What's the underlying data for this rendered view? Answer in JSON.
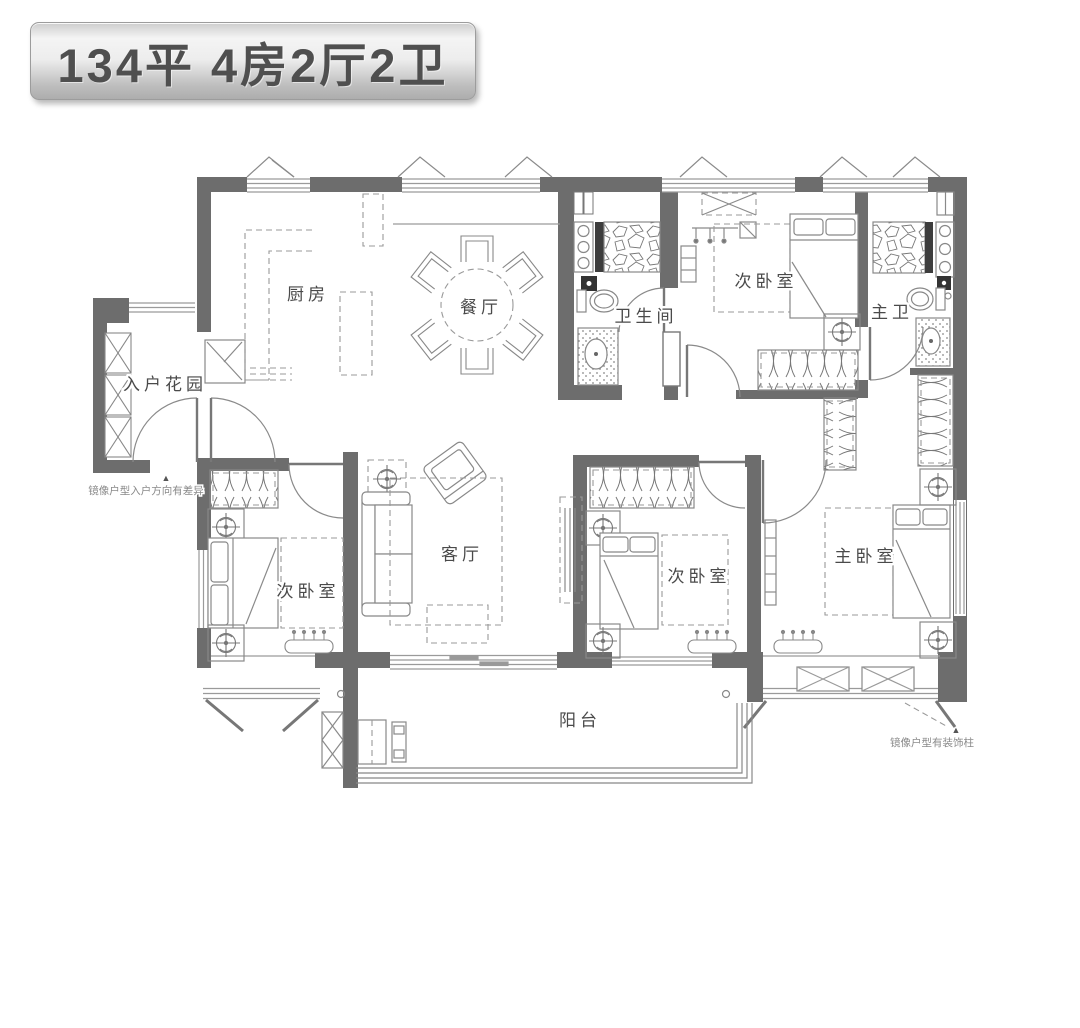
{
  "title": {
    "text": "134平  4房2厅2卫"
  },
  "rooms": {
    "entry_garden": {
      "label": "入户花园"
    },
    "kitchen": {
      "label": "厨房"
    },
    "dining": {
      "label": "餐厅"
    },
    "bathroom": {
      "label": "卫生间"
    },
    "bedroom_top": {
      "label": "次卧室"
    },
    "master_bath": {
      "label": "主卫"
    },
    "living": {
      "label": "客厅"
    },
    "bedroom_left": {
      "label": "次卧室"
    },
    "bedroom_middle": {
      "label": "次卧室"
    },
    "master_bedroom": {
      "label": "主卧室"
    },
    "balcony": {
      "label": "阳台"
    }
  },
  "annotations": {
    "entry_note": {
      "marker": "▲",
      "text": "镜像户型入户方向有差异"
    },
    "column_note": {
      "marker": "▲",
      "text": "镜像户型有装饰柱"
    }
  },
  "colors": {
    "wall": "#6d6d6d",
    "line": "#8a8a8a",
    "label": "#4a4a4a",
    "banner_text": "#4f4f4f"
  }
}
